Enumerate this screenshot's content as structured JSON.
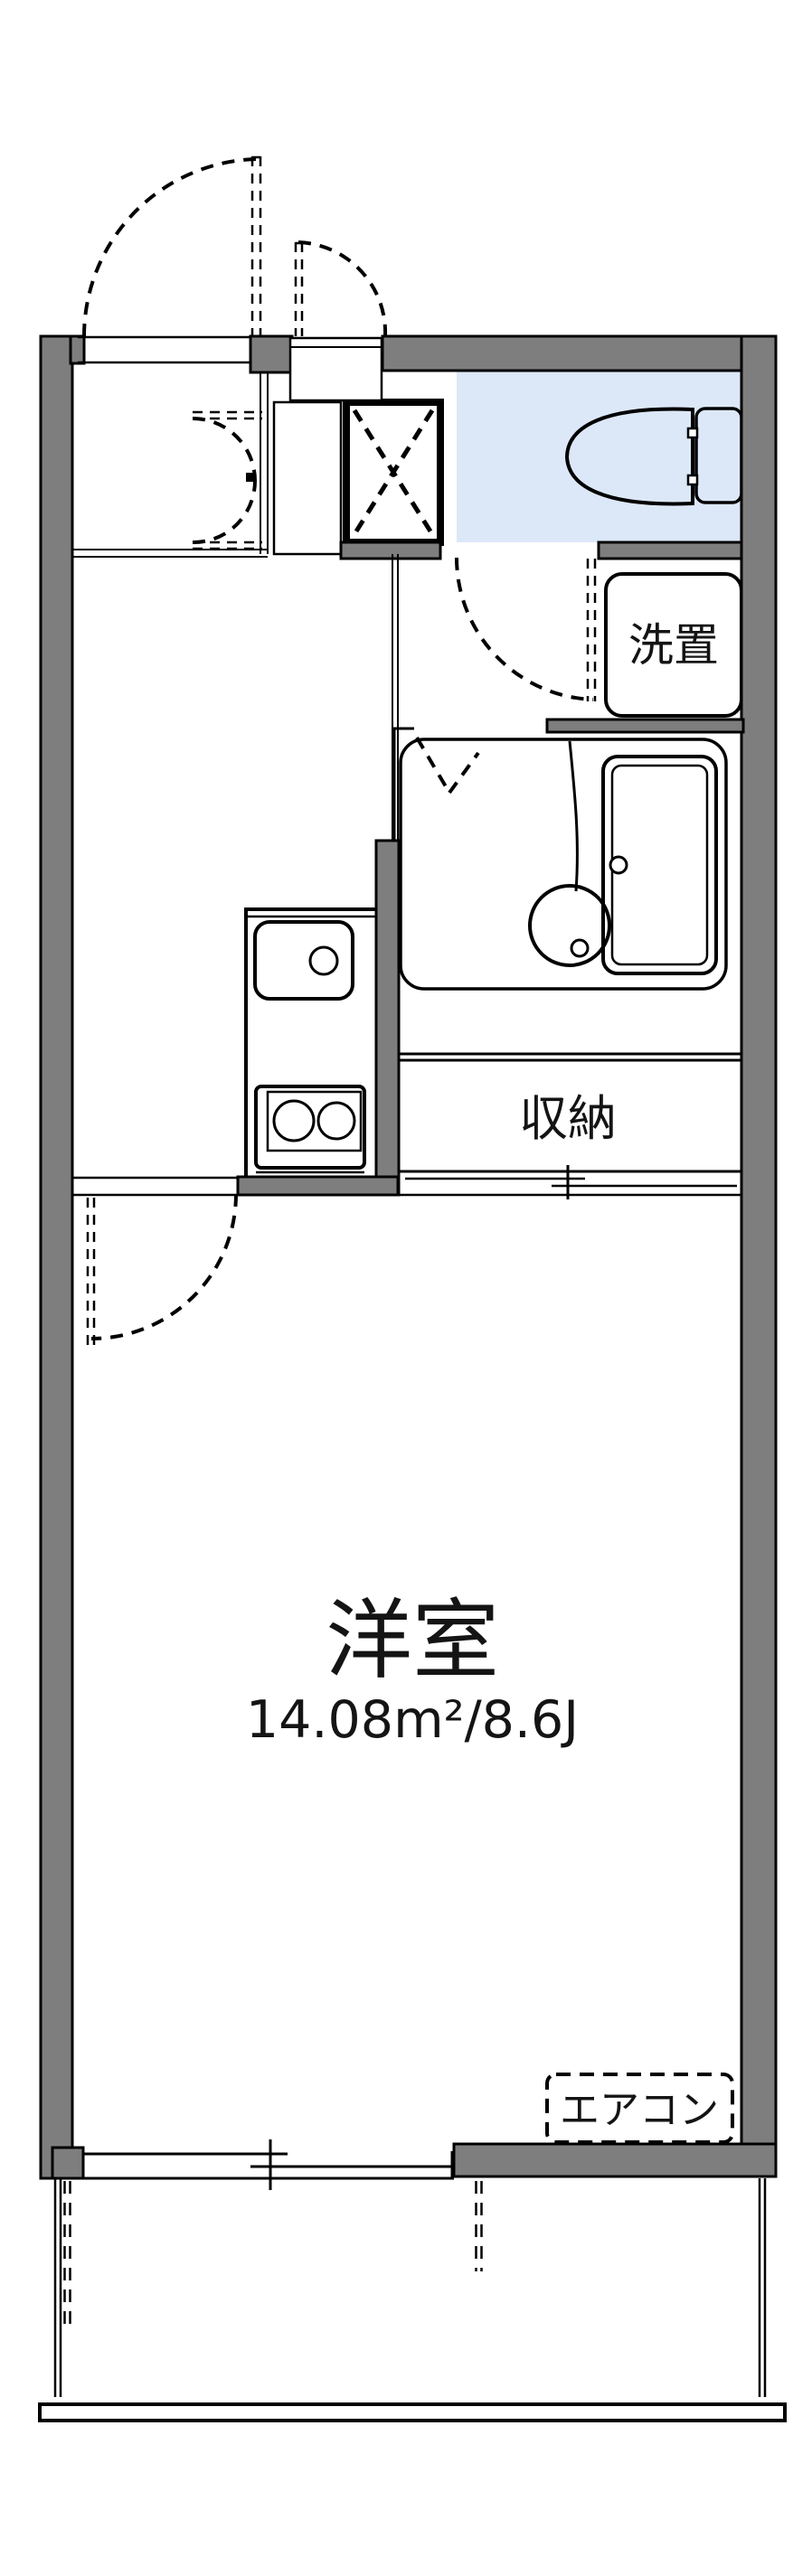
{
  "labels": {
    "washer_space": "洗置",
    "storage": "収納",
    "main_room": "洋室",
    "main_room_area": "14.08m²/8.6J",
    "air_conditioner": "エアコン"
  },
  "colors": {
    "wall-gray": "#7e7e7e",
    "fixture-blue": "#dce8f8",
    "cream": "#fdf2da",
    "line": "#000000"
  }
}
